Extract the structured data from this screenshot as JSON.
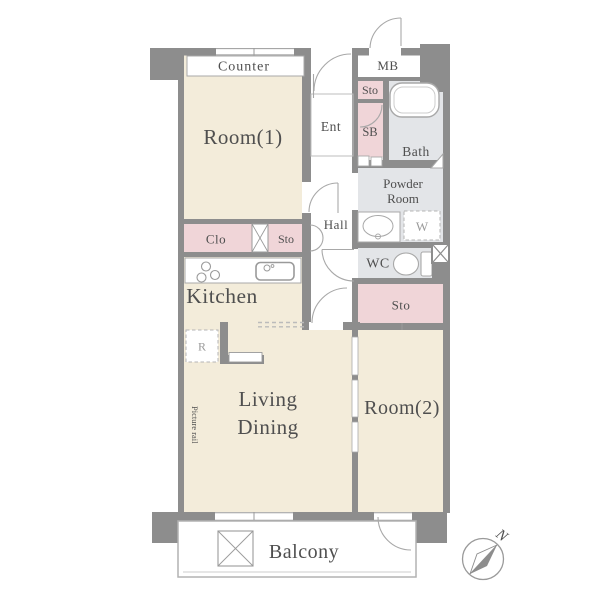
{
  "plan": {
    "rooms": {
      "room1": "Room(1)",
      "room2": "Room(2)",
      "living_line1": "Living",
      "living_line2": "Dining",
      "kitchen": "Kitchen",
      "hall": "Hall",
      "ent": "Ent",
      "bath": "Bath",
      "powder_line1": "Powder",
      "powder_line2": "Room",
      "wc": "WC",
      "balcony": "Balcony"
    },
    "storage": {
      "counter": "Counter",
      "mb": "MB",
      "sto_top": "Sto",
      "sb": "SB",
      "clo": "Clo",
      "sto_mid": "Sto",
      "sto_right": "Sto",
      "washer": "W",
      "fridge": "R"
    },
    "annotations": {
      "picture_rail": "Picture rail",
      "compass_north": "N"
    }
  },
  "colors": {
    "wall": "#8d8d8d",
    "cream": "#f3ecda",
    "pink": "#f0d5d8",
    "grayroom": "#e3e5e8",
    "line": "#a8a8a8",
    "text": "#4f4f4f",
    "subtle": "#9a9a9a"
  }
}
